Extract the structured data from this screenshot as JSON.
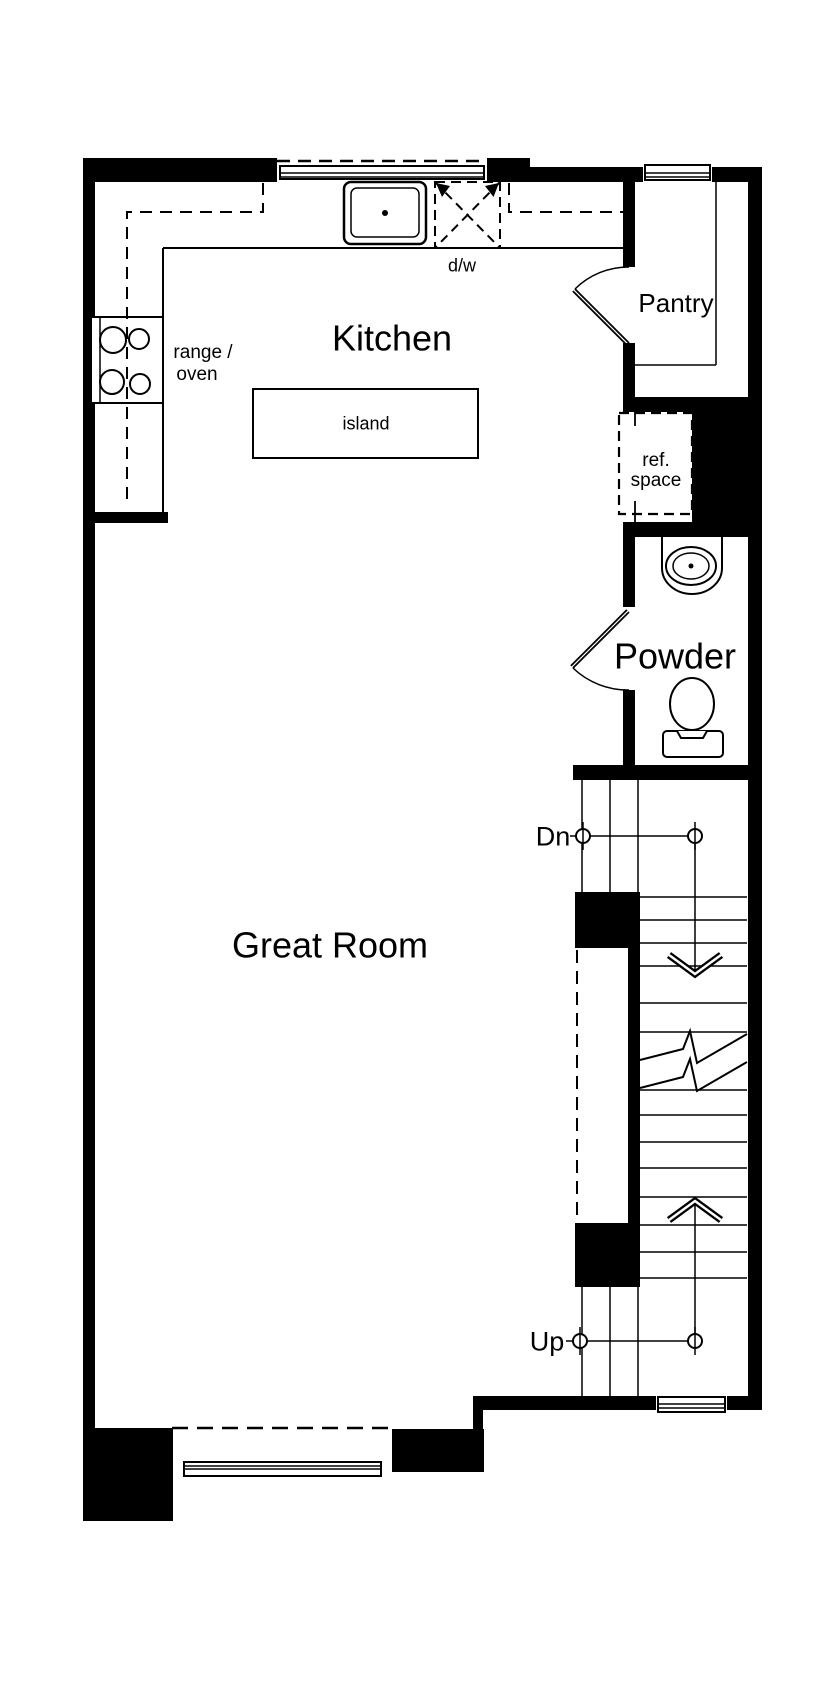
{
  "meta": {
    "description": "Residential floor plan, main level",
    "background_color": "#ffffff",
    "wall_color": "#000000",
    "line_color": "#000000"
  },
  "rooms": {
    "kitchen": {
      "label": "Kitchen"
    },
    "pantry": {
      "label": "Pantry"
    },
    "powder": {
      "label": "Powder"
    },
    "great_room": {
      "label": "Great Room"
    }
  },
  "fixtures": {
    "island": {
      "label": "island"
    },
    "range_oven": {
      "label_line1": "range /",
      "label_line2": "oven"
    },
    "dishwasher": {
      "label": "d/w"
    },
    "ref_space": {
      "label_line1": "ref.",
      "label_line2": "space"
    }
  },
  "stairs": {
    "down_label": "Dn",
    "up_label": "Up"
  }
}
